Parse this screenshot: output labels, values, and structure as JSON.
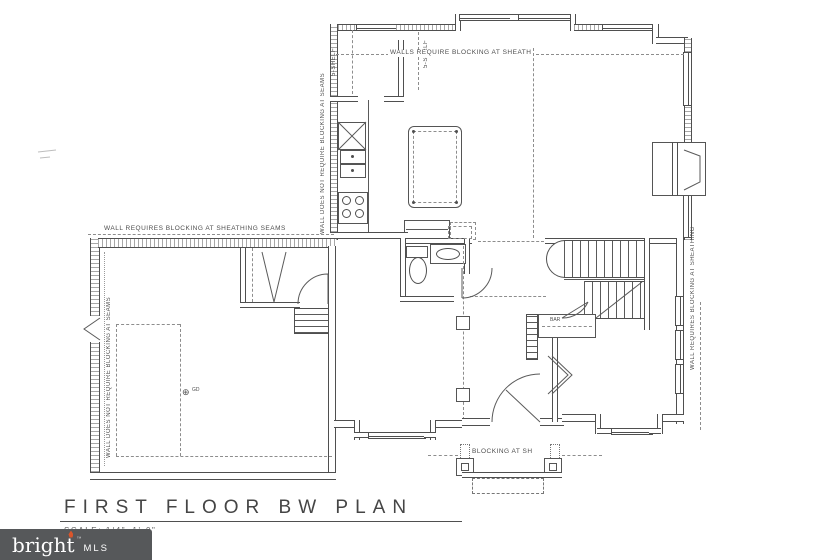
{
  "plan": {
    "title": "FIRST FLOOR BW PLAN",
    "scale": "SCALE: 1/4\"=1'-0\"",
    "notes": {
      "top": "WALLS REQUIRE BLOCKING AT SHEATH",
      "garage_top": "WALL REQUIRES BLOCKING AT SHEATHING SEAMS",
      "kitchen_wall": "WALL DOES NOT REQUIRE BLOCKING AT SEAMS",
      "garage_left": "WALL DOES NOT REQUIRE BLOCKING AT SEAMS",
      "right_wall": "WALL REQUIRES BLOCKING AT SHEATHING",
      "porch": "BLOCKING AT SH"
    },
    "labels": {
      "shelf_left": "5-SHELF",
      "shelf_right": "5-SHELF",
      "bar": "BAR",
      "gd_symbol": "⊕",
      "gd": "GD"
    }
  },
  "watermark": {
    "brand": "bright",
    "suffix": "MLS",
    "tm": "™",
    "bg_color": "#56585A",
    "accent_color": "#D9552B"
  },
  "colors": {
    "line": "#4f4f4f",
    "dash": "#8d8d8d",
    "background": "#ffffff"
  }
}
